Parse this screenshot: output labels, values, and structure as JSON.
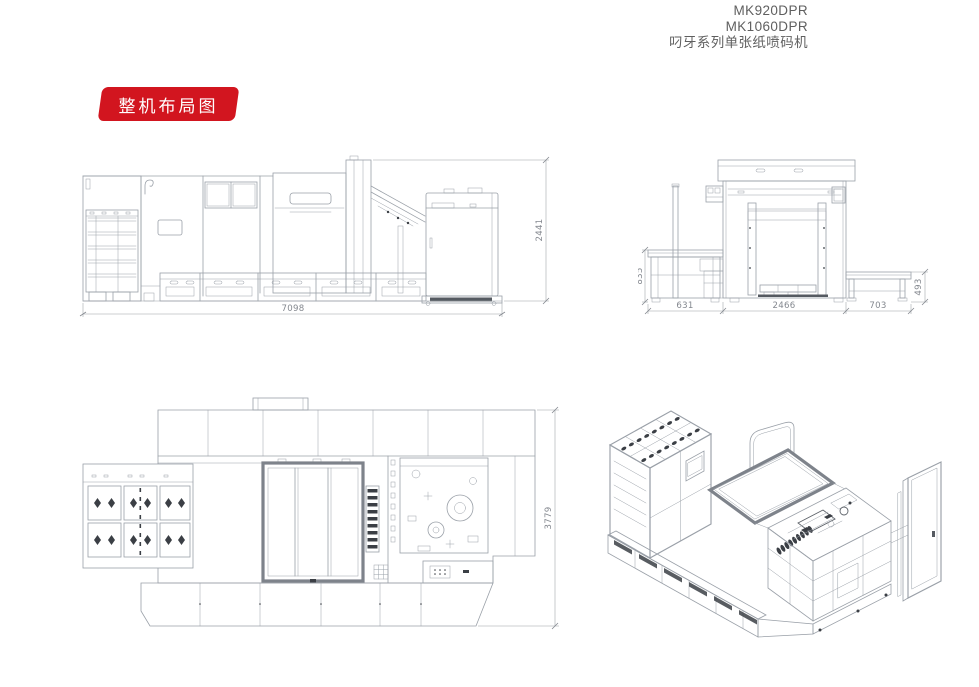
{
  "header": {
    "model_1": "MK920DPR",
    "model_2": "MK1060DPR",
    "series": "叼牙系列单张纸喷码机"
  },
  "badge": {
    "label": "整机布局图",
    "color": "#d2151f"
  },
  "dims": {
    "side": {
      "width": "7098",
      "height": "2441"
    },
    "front": {
      "left_width": "631",
      "center_width": "2466",
      "right_width": "703",
      "left_height": "835",
      "right_height": "493"
    },
    "plan": {
      "depth": "3779"
    }
  },
  "colors": {
    "line": "#9aa0a8",
    "dim_text": "#84888f",
    "dark_detail": "#3b3f45",
    "header_text": "#5f5f5f"
  }
}
